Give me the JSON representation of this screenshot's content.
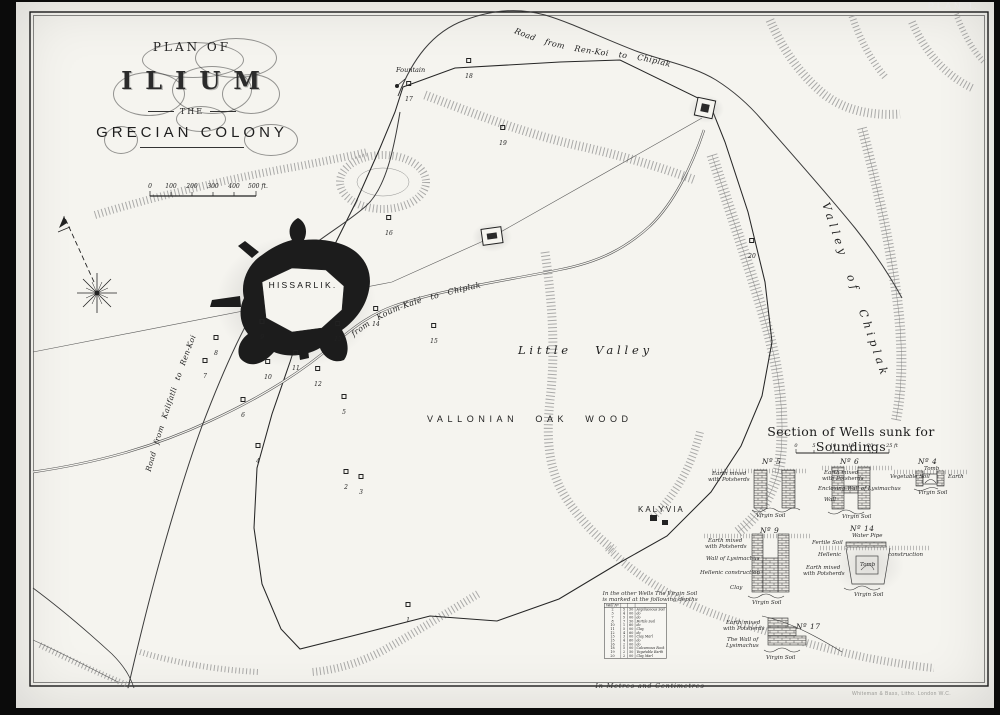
{
  "page": {
    "plate_label": "PLAN  I.",
    "printer_credit": "Whiteman & Bass, Litho. London W.C."
  },
  "title": {
    "line1": "PLAN OF",
    "line2": "ILIUM",
    "line3": "THE",
    "line4": "GRECIAN COLONY"
  },
  "main_scale": {
    "ticks": [
      "0",
      "100",
      "200",
      "300",
      "400",
      "500 ft."
    ]
  },
  "map": {
    "labels": {
      "hissarlik": "HISSARLIK.",
      "little_valley": "Little Valley",
      "oak_wood": "VALLONIAN OAK WOOD",
      "kalyvia": "KALYVIA",
      "valley_of_chiplak": "Valley of Chiplak",
      "fountain": "Fountain",
      "road_top": "Road from Ren-Koi to Chiplak",
      "road_koumkale": "Road from Koum-Kalé to Chiplak",
      "road_kalifatli": "Road from Kalifatli to Ren-Koi"
    },
    "wells": [
      {
        "n": "1",
        "x": 408,
        "y": 614
      },
      {
        "n": "2",
        "x": 346,
        "y": 481
      },
      {
        "n": "3",
        "x": 361,
        "y": 486
      },
      {
        "n": "4",
        "x": 258,
        "y": 455
      },
      {
        "n": "5",
        "x": 344,
        "y": 406
      },
      {
        "n": "6",
        "x": 243,
        "y": 409
      },
      {
        "n": "7",
        "x": 205,
        "y": 370
      },
      {
        "n": "8",
        "x": 216,
        "y": 347
      },
      {
        "n": "9",
        "x": 262,
        "y": 331
      },
      {
        "n": "10",
        "x": 268,
        "y": 371
      },
      {
        "n": "11",
        "x": 296,
        "y": 362
      },
      {
        "n": "12",
        "x": 318,
        "y": 378
      },
      {
        "n": "13",
        "x": 338,
        "y": 333
      },
      {
        "n": "14",
        "x": 376,
        "y": 318
      },
      {
        "n": "15",
        "x": 434,
        "y": 335
      },
      {
        "n": "16",
        "x": 389,
        "y": 227
      },
      {
        "n": "17",
        "x": 409,
        "y": 93
      },
      {
        "n": "18",
        "x": 469,
        "y": 70
      },
      {
        "n": "19",
        "x": 503,
        "y": 137
      },
      {
        "n": "20",
        "x": 752,
        "y": 250
      }
    ]
  },
  "wells_section": {
    "title": "Section of Wells sunk for Soundings",
    "scale_ticks": [
      "0",
      "5",
      "10",
      "15",
      "20",
      "25 ft"
    ],
    "sections": [
      {
        "no": "Nº 5",
        "labels": {
          "l1": "Earth mixed",
          "l2": "with Potsherds",
          "bottom": "Virgin Soil"
        }
      },
      {
        "no": "Nº 6",
        "labels": {
          "l1": "Earth mixed",
          "l2": "with Potsherds",
          "l3": "Enclosing Wall of Lysimachus",
          "l4": "Wall",
          "bottom": "Virgin Soil"
        }
      },
      {
        "no": "Nº 4",
        "labels": {
          "l1": "Vegetable Soil",
          "l2": "Tomb",
          "l3": "Earth",
          "bottom": "Virgin Soil"
        }
      },
      {
        "no": "Nº 9",
        "labels": {
          "l1": "Earth mixed",
          "l2": "with Potsherds",
          "l3": "Wall of Lysimachus",
          "l4": "Hellenic construction",
          "l5": "Clay",
          "bottom": "Virgin Soil"
        }
      },
      {
        "no": "Nº 14",
        "labels": {
          "l1": "Water Pipe",
          "l2": "Fertile Soil",
          "l3": "Hellenic",
          "l4": "construction",
          "l5": "Earth mixed",
          "l6": "with Potsherds",
          "l7": "Tomb",
          "bottom": "Virgin Soil"
        }
      },
      {
        "no": "Nº 17",
        "labels": {
          "l1": "Earth mixed",
          "l2": "with Potsherds",
          "l3": "The Wall of",
          "l4": "Lysimachus",
          "bottom": "Virgin Soil"
        }
      }
    ]
  },
  "depth_table": {
    "intro1": "In the other Wells The Virgin Soil",
    "intro2": "is marked at the following depths",
    "header": "Well Nº",
    "rows": [
      [
        "2",
        "5",
        "50",
        "Argillaceous Soil"
      ],
      [
        "3",
        "4",
        "00",
        "do"
      ],
      [
        "7",
        "5",
        "00",
        "do"
      ],
      [
        "8",
        "7",
        "50",
        "Fertile Soil"
      ],
      [
        "10",
        "1",
        "60",
        "do"
      ],
      [
        "11",
        "5",
        "00",
        "Clay"
      ],
      [
        "12",
        "4",
        "60",
        "do"
      ],
      [
        "13",
        "3",
        "00",
        "Clay Marl"
      ],
      [
        "15",
        "4",
        "60",
        "do"
      ],
      [
        "16",
        "2",
        "00",
        "do"
      ],
      [
        "18",
        "5",
        "00",
        "Calcareous Rock"
      ],
      [
        "19",
        "2",
        "50",
        "Vegetable Earth"
      ],
      [
        "20",
        "2",
        "00",
        "Clay Marl"
      ]
    ],
    "footer": "In Metres and Centimetres"
  }
}
